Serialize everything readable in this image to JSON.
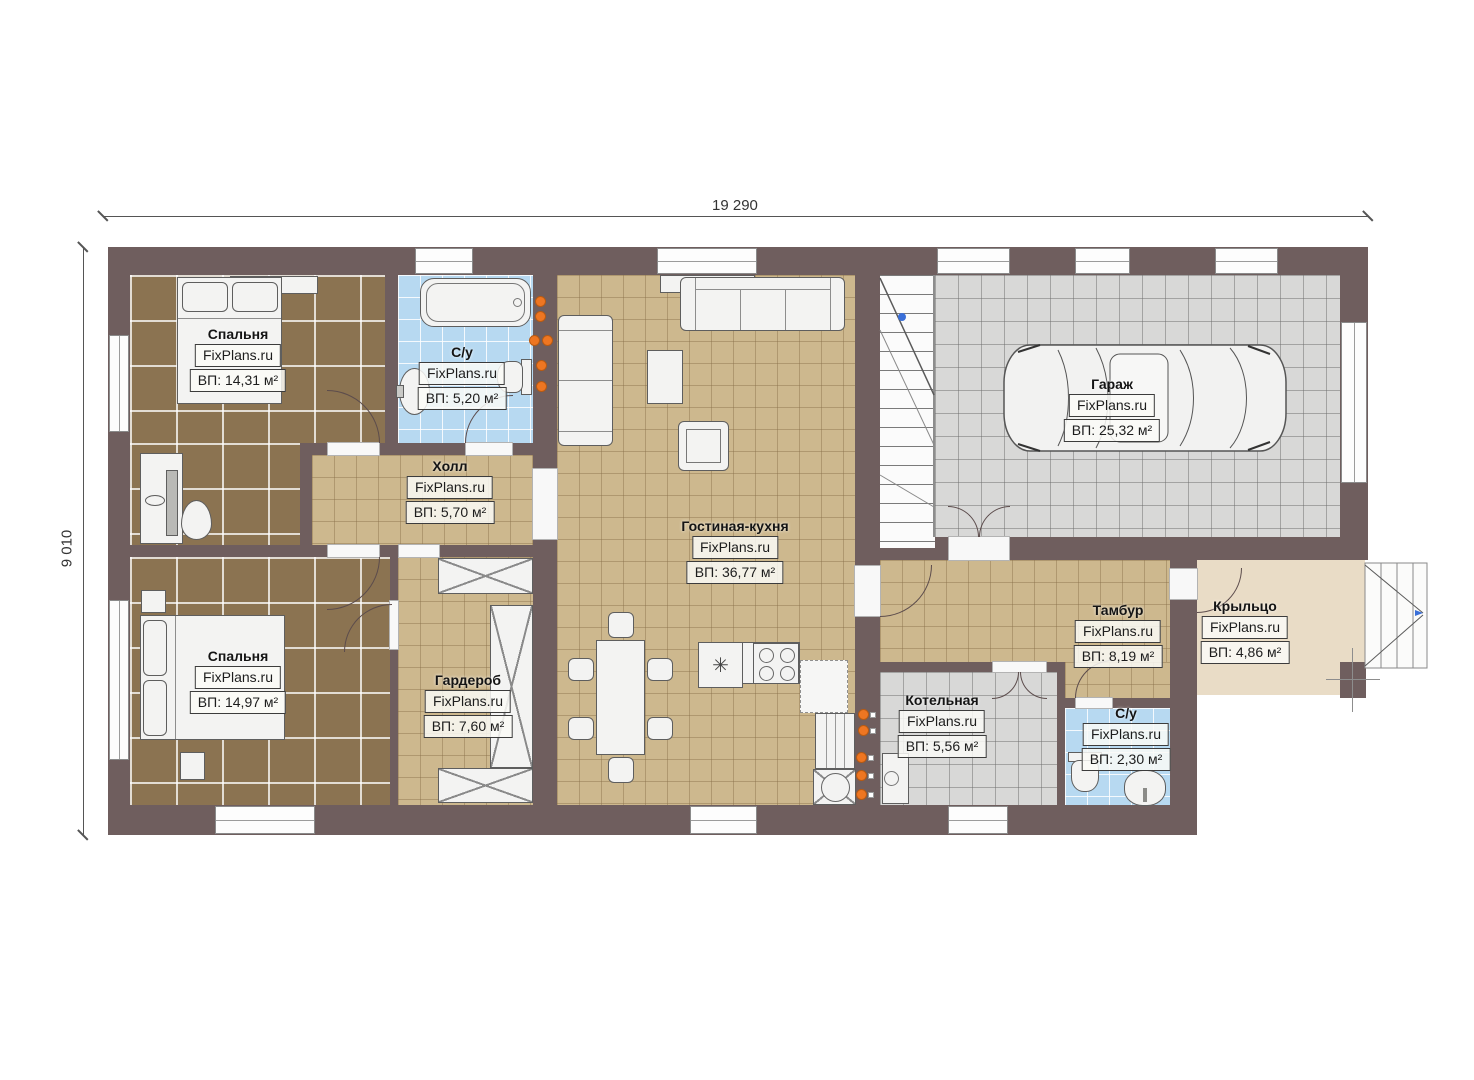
{
  "brand": "FixPlans.ru",
  "dimensions": {
    "width": "19 290",
    "height": "9 010"
  },
  "rooms": {
    "bedroom1": {
      "name": "Спальня",
      "area": "ВП: 14,31 м²"
    },
    "bath1": {
      "name": "С/у",
      "area": "ВП: 5,20 м²"
    },
    "hall": {
      "name": "Холл",
      "area": "ВП: 5,70 м²"
    },
    "living": {
      "name": "Гостиная-кухня",
      "area": "ВП: 36,77 м²"
    },
    "garage": {
      "name": "Гараж",
      "area": "ВП: 25,32 м²"
    },
    "bedroom2": {
      "name": "Спальня",
      "area": "ВП: 14,97 м²"
    },
    "wardrobe": {
      "name": "Гардероб",
      "area": "ВП: 7,60 м²"
    },
    "tambour": {
      "name": "Тамбур",
      "area": "ВП: 8,19 м²"
    },
    "porch": {
      "name": "Крыльцо",
      "area": "ВП: 4,86 м²"
    },
    "boiler": {
      "name": "Котельная",
      "area": "ВП: 5,56 м²"
    },
    "bath2": {
      "name": "С/у",
      "area": "ВП: 2,30 м²"
    }
  },
  "icons": {
    "sink_glyph": "✳"
  },
  "colors": {
    "wall": "#6f5e5e",
    "floor_tan": "#cdb88e",
    "floor_bedroom": "#8b7351",
    "floor_bath": "#b7d9f1",
    "floor_garage": "#d8d8d7",
    "floor_porch": "#e9dcc6",
    "marker_orange": "#ee7622",
    "marker_blue": "#3a6fd8"
  }
}
